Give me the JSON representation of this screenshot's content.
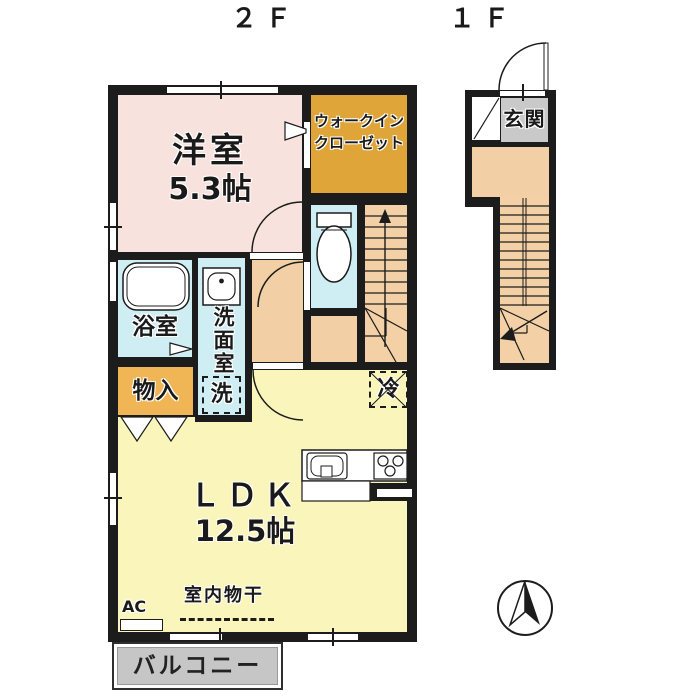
{
  "floors": {
    "f2": "２Ｆ",
    "f1": "１Ｆ"
  },
  "rooms": {
    "western_room": {
      "name": "洋室",
      "size": "5.3帖"
    },
    "walk_in_closet": {
      "name_line1": "ウォークイン",
      "name_line2": "クローゼット"
    },
    "bathroom": {
      "name": "浴室"
    },
    "washroom": {
      "name": "洗面室",
      "washer": "洗"
    },
    "storage": {
      "name": "物入"
    },
    "refrigerator": {
      "name": "冷"
    },
    "ldk": {
      "name": "ＬＤＫ",
      "size": "12.5帖"
    },
    "balcony": {
      "name": "バルコニー"
    },
    "entrance": {
      "name": "玄関"
    }
  },
  "annotations": {
    "ac": "AC",
    "indoor_drying": "室内物干"
  },
  "icons": {
    "compass": "north-arrow"
  },
  "colors": {
    "wall": "#1c1c1c",
    "western_room_fill": "#f8e2dd",
    "closet_fill": "#dfa538",
    "storage_fill": "#f0b554",
    "wet_area_fill": "#cfeef3",
    "hallway_fill": "#f2cfa4",
    "ldk_fill": "#faf5bb",
    "balcony_fill": "#c6c6c6",
    "entrance_tile_fill": "#c9c9c9"
  }
}
